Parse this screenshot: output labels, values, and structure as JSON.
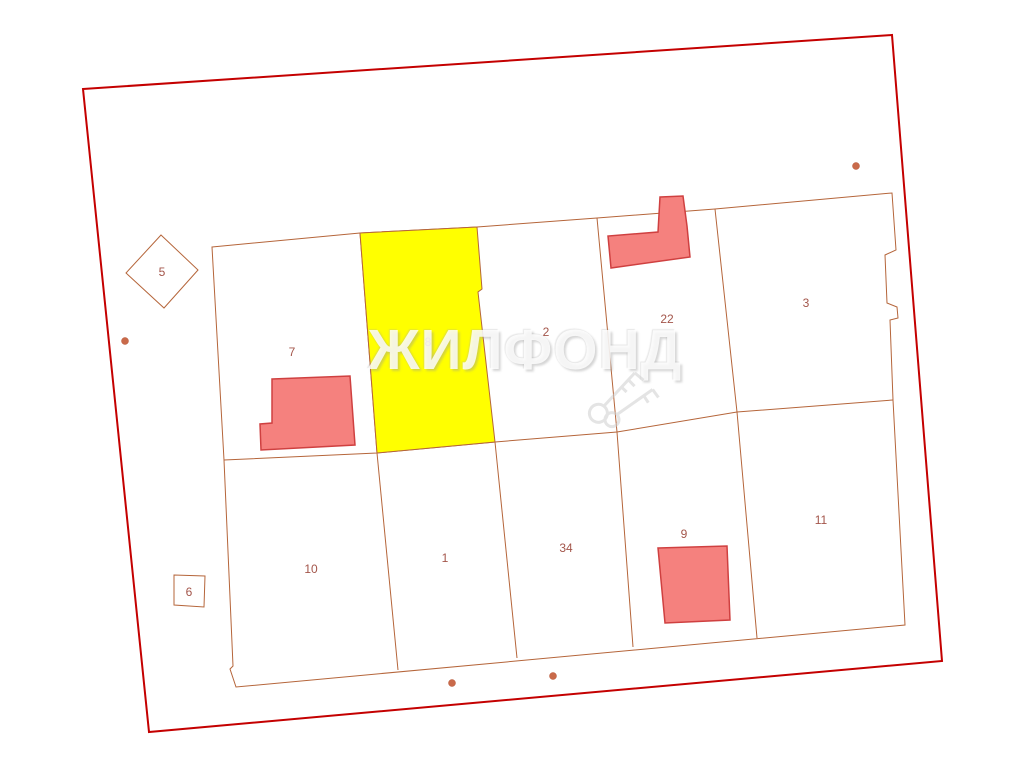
{
  "map": {
    "watermark": {
      "text": "ЖИЛФОНД"
    },
    "colors": {
      "outer_boundary": "#c40000",
      "parcel_line": "#b5653a",
      "highlight_fill": "#ffff00",
      "building_fill": "#f5817e",
      "building_border": "#cf4040",
      "dot": "#c96a4a",
      "label": "#a3554a"
    },
    "plots": [
      {
        "id": "5"
      },
      {
        "id": "6"
      },
      {
        "id": "7"
      },
      {
        "id": "8",
        "highlighted": true
      },
      {
        "id": "2"
      },
      {
        "id": "22"
      },
      {
        "id": "3"
      },
      {
        "id": "10"
      },
      {
        "id": "1"
      },
      {
        "id": "34"
      },
      {
        "id": "9"
      },
      {
        "id": "11"
      }
    ]
  }
}
